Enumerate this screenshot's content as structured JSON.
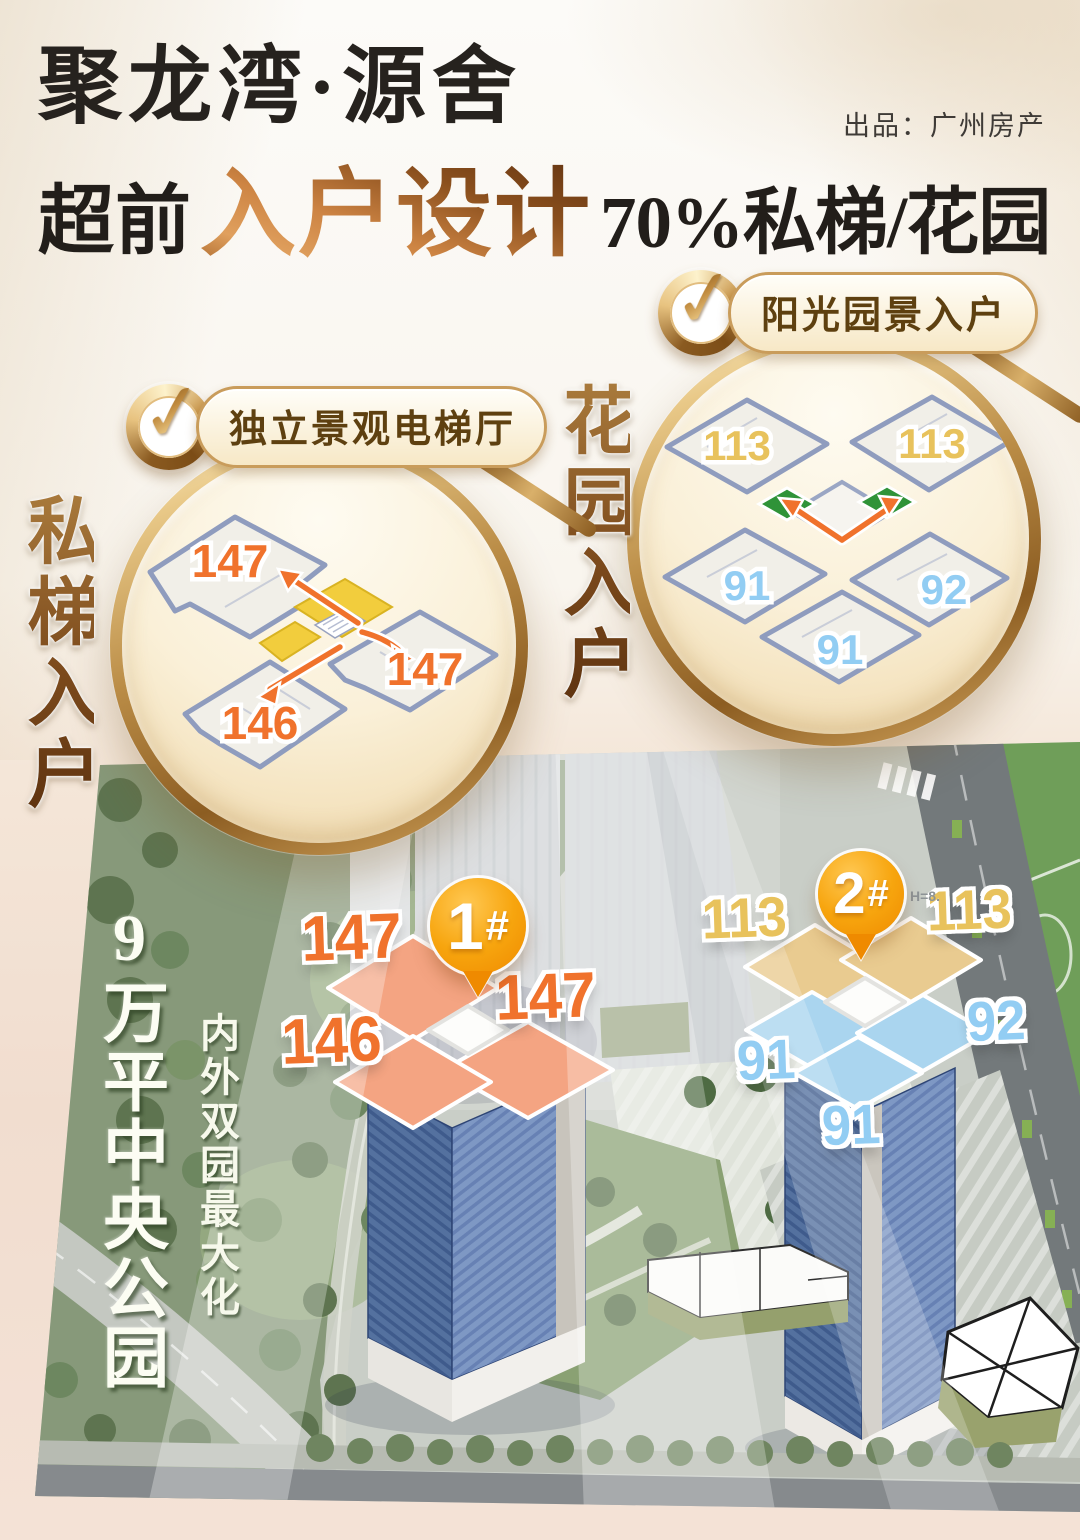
{
  "header": {
    "title": "聚龙湾·源舍",
    "publisher": "出品：广州房产",
    "subtitle_prefix": "超前",
    "subtitle_highlight": "入户设计",
    "subtitle_suffix": "70%私梯/花园"
  },
  "icons": {
    "check_glyph": "✓"
  },
  "feature_left": {
    "badge_label": "独立景观电梯厅",
    "side_label": "私梯入户",
    "units": [
      "147",
      "147",
      "146"
    ],
    "unit_color": "#f0722c",
    "elevator_hall_color": "#f2cd3d",
    "arrow_color": "#f0722c"
  },
  "feature_right": {
    "badge_label": "阳光园景入户",
    "side_label": "花园入户",
    "units_gold": [
      "113",
      "113"
    ],
    "units_blue": [
      "91",
      "92",
      "91"
    ],
    "gold_color": "#e8c25c",
    "blue_color": "#92cdf3",
    "garden_color": "#2f9338",
    "arrow_color": "#f0722c"
  },
  "site_plan": {
    "park_label_big": "9万平中央公园",
    "park_label_small": "内外双园最大化",
    "marker_color": "#f39200",
    "building1": {
      "marker_number": "1",
      "marker_suffix": "#",
      "units": [
        "147",
        "147",
        "146"
      ],
      "unit_color": "#f0722c",
      "roof_color": "#f4a482"
    },
    "building2": {
      "marker_number": "2",
      "marker_suffix": "#",
      "height_note": "H=8.",
      "units_gold": [
        "113",
        "113"
      ],
      "units_blue": [
        "91",
        "92",
        "91"
      ],
      "gold_roof_color": "#e9cb90",
      "blue_roof_color": "#aad5ef"
    }
  },
  "colors": {
    "accent_bronze": "#8a5a24",
    "badge_text": "#5e4010",
    "title_black": "#26221e",
    "page_pink": "#f1ddcf",
    "gold_ring": "#c49a55"
  }
}
